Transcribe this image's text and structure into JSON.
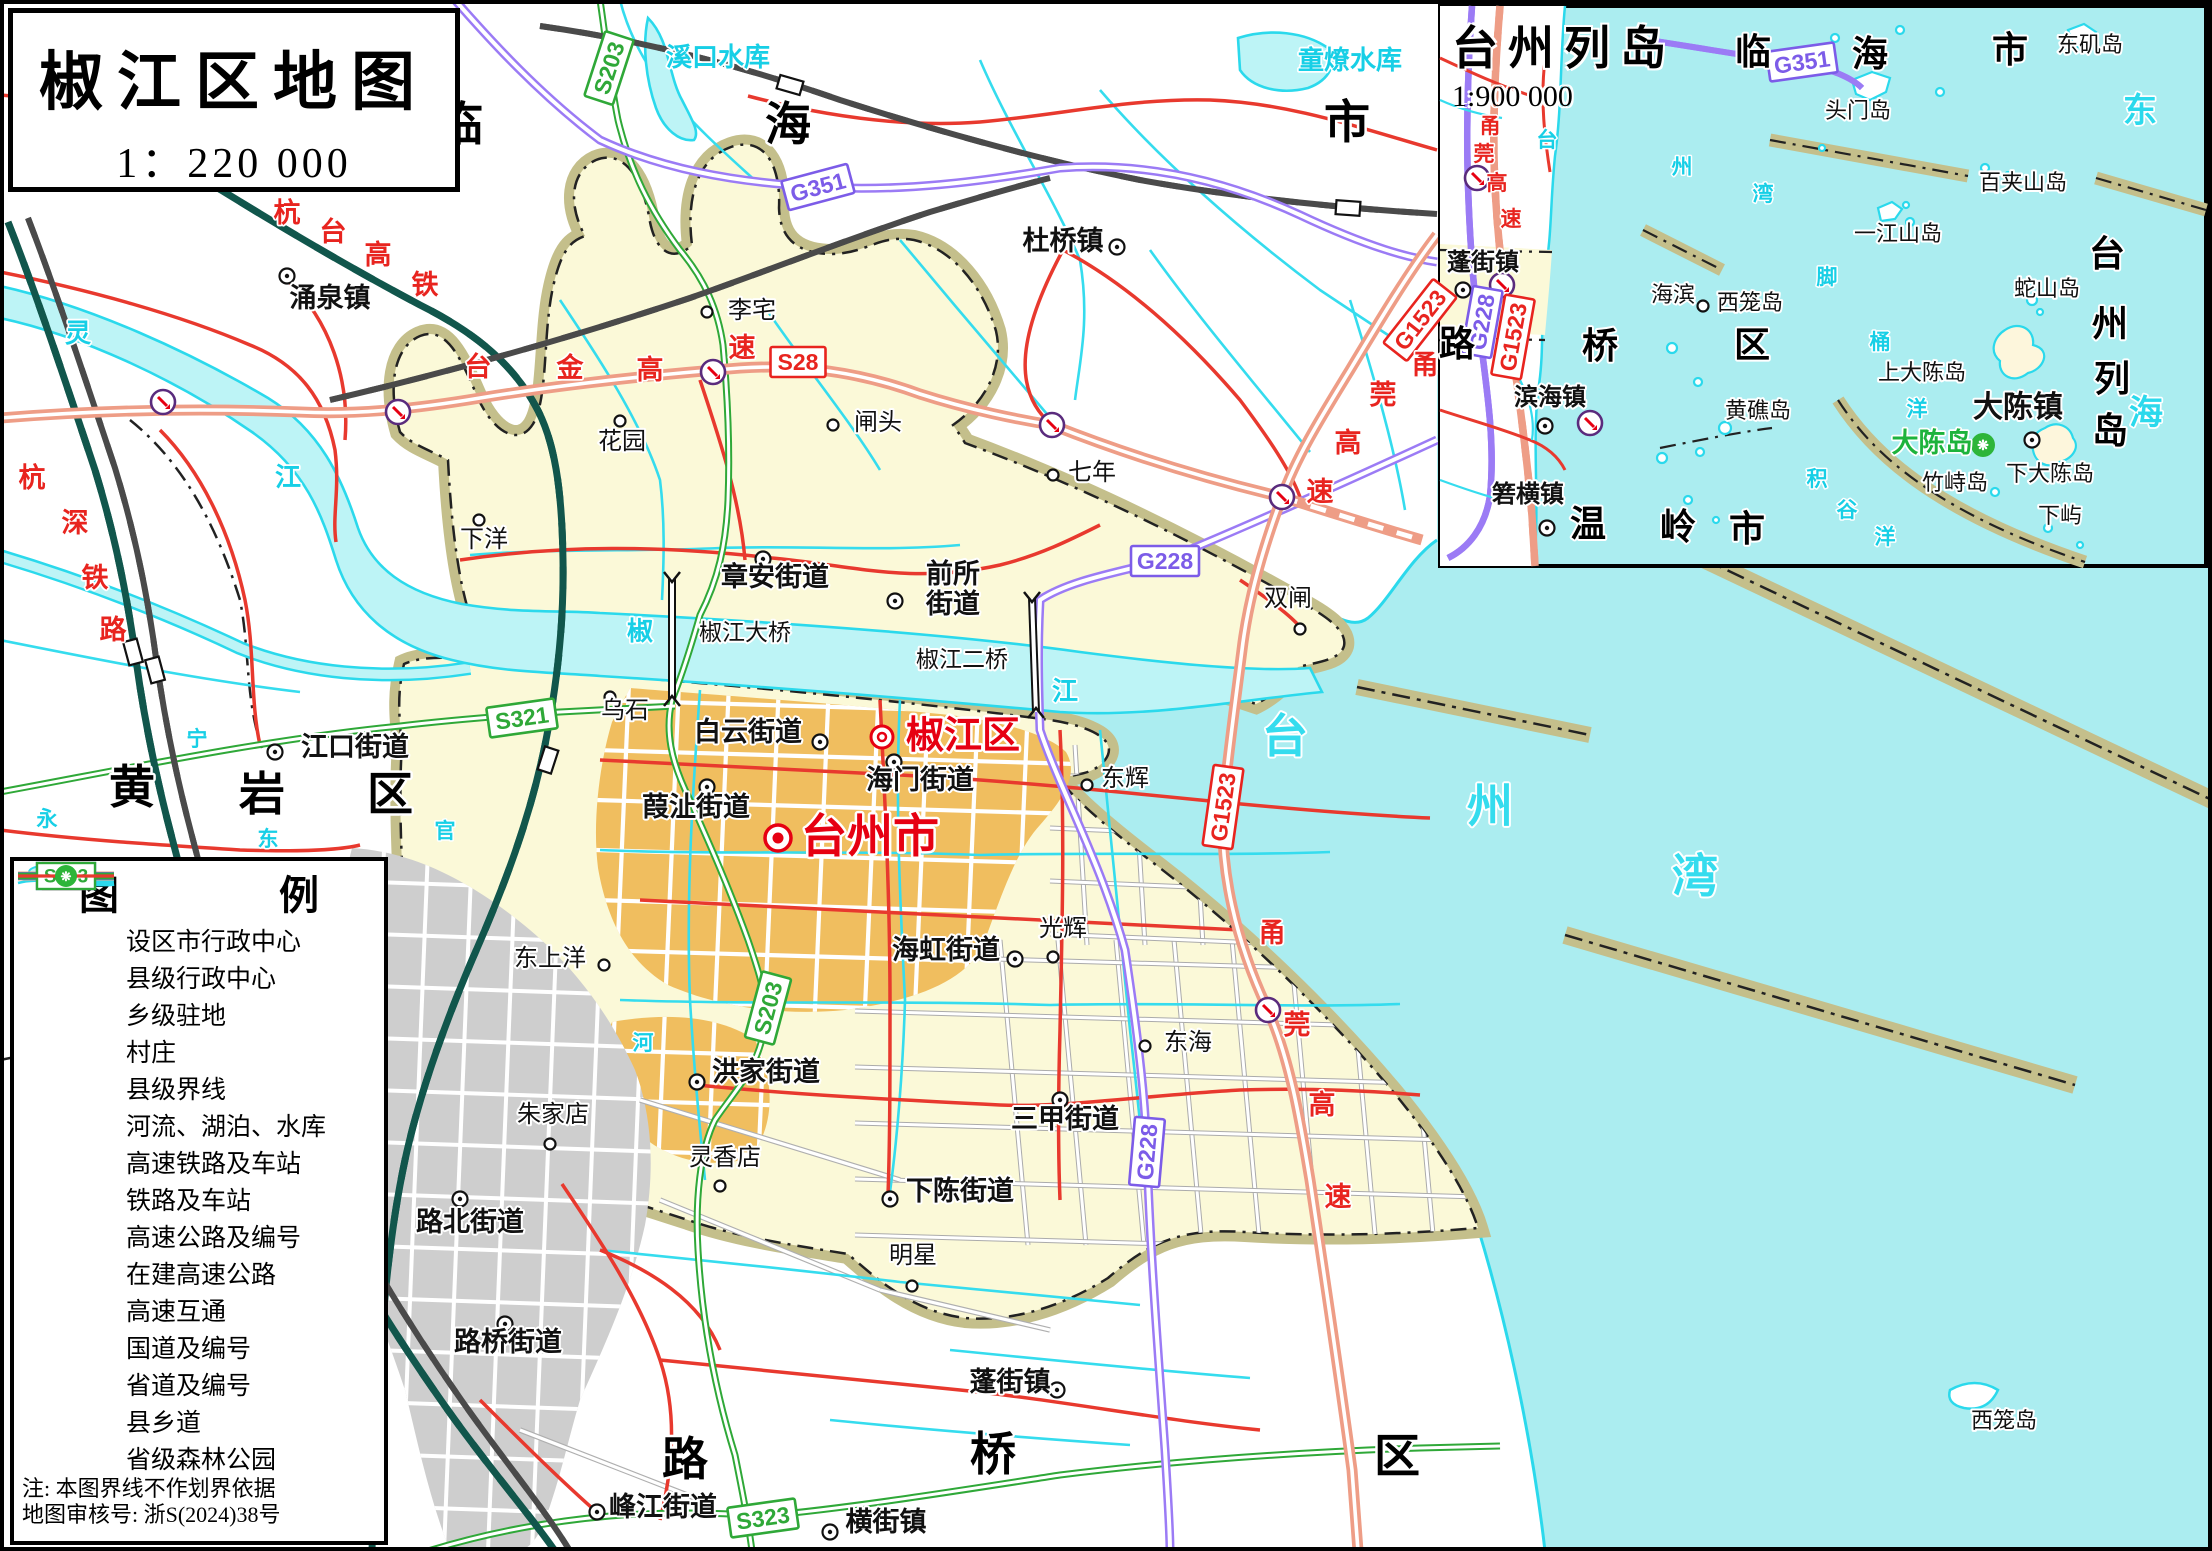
{
  "title_box": {
    "title": "椒江区地图",
    "scale": "1：220 000"
  },
  "inset": {
    "title": "台州列岛",
    "scale": "1:900 000",
    "labels": [
      {
        "t": "临",
        "x": 1753,
        "y": 64,
        "c": "inset-region"
      },
      {
        "t": "海",
        "x": 1870,
        "y": 66,
        "c": "inset-region"
      },
      {
        "t": "市",
        "x": 2010,
        "y": 62,
        "c": "inset-region"
      },
      {
        "t": "路",
        "x": 1457,
        "y": 356,
        "c": "inset-region"
      },
      {
        "t": "桥",
        "x": 1600,
        "y": 358,
        "c": "inset-region"
      },
      {
        "t": "区",
        "x": 1752,
        "y": 357,
        "c": "inset-region"
      },
      {
        "t": "温",
        "x": 1588,
        "y": 536,
        "c": "inset-region"
      },
      {
        "t": "岭",
        "x": 1678,
        "y": 539,
        "c": "inset-region"
      },
      {
        "t": "市",
        "x": 1747,
        "y": 541,
        "c": "inset-region"
      },
      {
        "t": "台",
        "x": 2107,
        "y": 266,
        "c": "inset-region"
      },
      {
        "t": "州",
        "x": 2110,
        "y": 336,
        "c": "inset-region"
      },
      {
        "t": "列",
        "x": 2112,
        "y": 391,
        "c": "inset-region"
      },
      {
        "t": "岛",
        "x": 2110,
        "y": 443,
        "c": "inset-region"
      },
      {
        "t": "东",
        "x": 2140,
        "y": 122,
        "c": "water-md"
      },
      {
        "t": "海",
        "x": 2146,
        "y": 424,
        "c": "water-md"
      },
      {
        "t": "台",
        "x": 1547,
        "y": 147,
        "c": "water-sm"
      },
      {
        "t": "州",
        "x": 1682,
        "y": 174,
        "c": "water-sm"
      },
      {
        "t": "湾",
        "x": 1763,
        "y": 201,
        "c": "water-sm"
      },
      {
        "t": "脚",
        "x": 1827,
        "y": 284,
        "c": "water-sm"
      },
      {
        "t": "桶",
        "x": 1880,
        "y": 349,
        "c": "water-sm"
      },
      {
        "t": "洋",
        "x": 1917,
        "y": 416,
        "c": "water-sm"
      },
      {
        "t": "积",
        "x": 1817,
        "y": 486,
        "c": "water-sm"
      },
      {
        "t": "谷",
        "x": 1847,
        "y": 517,
        "c": "water-sm"
      },
      {
        "t": "洋",
        "x": 1885,
        "y": 544,
        "c": "water-sm"
      },
      {
        "t": "东矶岛",
        "x": 2090,
        "y": 52,
        "c": "island"
      },
      {
        "t": "头门岛",
        "x": 1858,
        "y": 118,
        "c": "island"
      },
      {
        "t": "百夹山岛",
        "x": 2023,
        "y": 190,
        "c": "island"
      },
      {
        "t": "一江山岛",
        "x": 1898,
        "y": 241,
        "c": "island"
      },
      {
        "t": "蛇山岛",
        "x": 2047,
        "y": 296,
        "c": "island"
      },
      {
        "t": "西笼岛",
        "x": 1750,
        "y": 310,
        "c": "island"
      },
      {
        "t": "黄礁岛",
        "x": 1758,
        "y": 418,
        "c": "island"
      },
      {
        "t": "上大陈岛",
        "x": 1922,
        "y": 380,
        "c": "island"
      },
      {
        "t": "下大陈岛",
        "x": 2050,
        "y": 481,
        "c": "island"
      },
      {
        "t": "竹峙岛",
        "x": 1955,
        "y": 490,
        "c": "island"
      },
      {
        "t": "下屿",
        "x": 2060,
        "y": 523,
        "c": "island"
      },
      {
        "t": "海滨",
        "x": 1673,
        "y": 302,
        "c": "island"
      },
      {
        "t": "蓬街镇",
        "x": 1483,
        "y": 270,
        "c": "inset-town"
      },
      {
        "t": "滨海镇",
        "x": 1550,
        "y": 405,
        "c": "inset-town"
      },
      {
        "t": "箬横镇",
        "x": 1528,
        "y": 502,
        "c": "inset-town"
      },
      {
        "t": "大陈镇",
        "x": 2018,
        "y": 417,
        "c": "inset-town-lg"
      },
      {
        "t": "大陈岛",
        "x": 1932,
        "y": 452,
        "c": "green"
      },
      {
        "t": "甬",
        "x": 1490,
        "y": 133,
        "c": "roadname-sm"
      },
      {
        "t": "莞",
        "x": 1484,
        "y": 161,
        "c": "roadname-sm"
      },
      {
        "t": "高",
        "x": 1497,
        "y": 190,
        "c": "roadname-sm"
      },
      {
        "t": "速",
        "x": 1511,
        "y": 226,
        "c": "roadname-sm"
      }
    ],
    "markers": [
      {
        "k": "town",
        "x": 1463,
        "y": 290
      },
      {
        "k": "town",
        "x": 1545,
        "y": 426
      },
      {
        "k": "town",
        "x": 1547,
        "y": 528
      },
      {
        "k": "town",
        "x": 2032,
        "y": 440
      },
      {
        "k": "village",
        "x": 1703,
        "y": 306
      }
    ],
    "badges": [
      {
        "t": "G351",
        "x": 1802,
        "y": 62,
        "r": -8,
        "k": "purple"
      },
      {
        "t": "G228",
        "x": 1482,
        "y": 322,
        "r": -80,
        "k": "purple"
      },
      {
        "t": "G1523",
        "x": 1513,
        "y": 337,
        "r": -80,
        "k": "red"
      }
    ],
    "interchanges": [
      {
        "x": 1477,
        "y": 178
      },
      {
        "x": 1502,
        "y": 285
      },
      {
        "x": 1590,
        "y": 423
      }
    ],
    "forest_icons": [
      {
        "x": 1983,
        "y": 445
      }
    ]
  },
  "legend": {
    "title": "图　例",
    "items": [
      {
        "sym": "city",
        "label": "设区市行政中心"
      },
      {
        "sym": "county",
        "label": "县级行政中心"
      },
      {
        "sym": "town",
        "label": "乡级驻地"
      },
      {
        "sym": "village",
        "label": "村庄"
      },
      {
        "sym": "boundary",
        "label": "县级界线"
      },
      {
        "sym": "water",
        "label": "河流、湖泊、水库"
      },
      {
        "sym": "hsr",
        "label": "高速铁路及车站"
      },
      {
        "sym": "rail",
        "label": "铁路及车站"
      },
      {
        "sym": "expwy",
        "badge": "S28",
        "label": "高速公路及编号"
      },
      {
        "sym": "expwy-uc",
        "label": "在建高速公路"
      },
      {
        "sym": "ic",
        "label": "高速互通"
      },
      {
        "sym": "g-road",
        "badge": "G104",
        "label": "国道及编号"
      },
      {
        "sym": "s-road",
        "badge": "S203",
        "label": "省道及编号"
      },
      {
        "sym": "county-road",
        "label": "县乡道"
      },
      {
        "sym": "forest",
        "label": "省级森林公园"
      }
    ],
    "notes": [
      "注:  本图界线不作划界依据",
      "地图审核号:  浙S(2024)38号"
    ]
  },
  "main_map": {
    "labels": [
      {
        "t": "涌泉镇",
        "x": 330,
        "y": 307,
        "c": "town"
      },
      {
        "t": "杜桥镇",
        "x": 1063,
        "y": 250,
        "c": "town"
      },
      {
        "t": "章安街道",
        "x": 775,
        "y": 586,
        "c": "town"
      },
      {
        "t": "前所",
        "x": 953,
        "y": 583,
        "c": "town"
      },
      {
        "t": "街道",
        "x": 953,
        "y": 613,
        "c": "town"
      },
      {
        "t": "江口街道",
        "x": 355,
        "y": 756,
        "c": "town"
      },
      {
        "t": "白云街道",
        "x": 748,
        "y": 741,
        "c": "town"
      },
      {
        "t": "海门街道",
        "x": 920,
        "y": 789,
        "c": "town"
      },
      {
        "t": "葭沚街道",
        "x": 696,
        "y": 816,
        "c": "town"
      },
      {
        "t": "海虹街道",
        "x": 946,
        "y": 959,
        "c": "town"
      },
      {
        "t": "洪家街道",
        "x": 766,
        "y": 1081,
        "c": "town"
      },
      {
        "t": "三甲街道",
        "x": 1065,
        "y": 1128,
        "c": "town"
      },
      {
        "t": "路北街道",
        "x": 470,
        "y": 1231,
        "c": "town"
      },
      {
        "t": "下陈街道",
        "x": 960,
        "y": 1200,
        "c": "town"
      },
      {
        "t": "路桥街道",
        "x": 508,
        "y": 1351,
        "c": "town"
      },
      {
        "t": "蓬街镇",
        "x": 1010,
        "y": 1391,
        "c": "town"
      },
      {
        "t": "峰江街道",
        "x": 663,
        "y": 1516,
        "c": "town"
      },
      {
        "t": "横街镇",
        "x": 886,
        "y": 1531,
        "c": "town"
      },
      {
        "t": "李宅",
        "x": 752,
        "y": 318,
        "c": "village"
      },
      {
        "t": "花园",
        "x": 622,
        "y": 449,
        "c": "village"
      },
      {
        "t": "闸头",
        "x": 878,
        "y": 430,
        "c": "village"
      },
      {
        "t": "七年",
        "x": 1092,
        "y": 480,
        "c": "village"
      },
      {
        "t": "下洋",
        "x": 484,
        "y": 547,
        "c": "village"
      },
      {
        "t": "双闸",
        "x": 1288,
        "y": 606,
        "c": "village"
      },
      {
        "t": "乌石",
        "x": 625,
        "y": 718,
        "c": "village"
      },
      {
        "t": "东辉",
        "x": 1125,
        "y": 786,
        "c": "village"
      },
      {
        "t": "东上洋",
        "x": 550,
        "y": 966,
        "c": "village"
      },
      {
        "t": "光辉",
        "x": 1063,
        "y": 936,
        "c": "village"
      },
      {
        "t": "东海",
        "x": 1188,
        "y": 1050,
        "c": "village"
      },
      {
        "t": "朱家店",
        "x": 553,
        "y": 1122,
        "c": "village"
      },
      {
        "t": "灵香店",
        "x": 725,
        "y": 1165,
        "c": "village"
      },
      {
        "t": "明星",
        "x": 913,
        "y": 1263,
        "c": "village"
      },
      {
        "t": "西笼岛",
        "x": 2004,
        "y": 1428,
        "c": "island"
      },
      {
        "t": "椒江大桥",
        "x": 745,
        "y": 640,
        "c": "bridge"
      },
      {
        "t": "椒江二桥",
        "x": 962,
        "y": 667,
        "c": "bridge"
      },
      {
        "t": "临",
        "x": 460,
        "y": 140,
        "c": "region"
      },
      {
        "t": "海",
        "x": 788,
        "y": 140,
        "c": "region"
      },
      {
        "t": "市",
        "x": 1347,
        "y": 138,
        "c": "region"
      },
      {
        "t": "黄",
        "x": 132,
        "y": 803,
        "c": "region"
      },
      {
        "t": "岩",
        "x": 262,
        "y": 810,
        "c": "region"
      },
      {
        "t": "区",
        "x": 390,
        "y": 810,
        "c": "region"
      },
      {
        "t": "路",
        "x": 685,
        "y": 1475,
        "c": "region"
      },
      {
        "t": "桥",
        "x": 993,
        "y": 1470,
        "c": "region"
      },
      {
        "t": "区",
        "x": 1397,
        "y": 1472,
        "c": "region"
      },
      {
        "t": "溪口水库",
        "x": 718,
        "y": 66,
        "c": "water"
      },
      {
        "t": "童燎水库",
        "x": 1350,
        "y": 69,
        "c": "water"
      },
      {
        "t": "灵",
        "x": 78,
        "y": 342,
        "c": "water"
      },
      {
        "t": "江",
        "x": 288,
        "y": 486,
        "c": "water"
      },
      {
        "t": "椒",
        "x": 640,
        "y": 640,
        "c": "water"
      },
      {
        "t": "江",
        "x": 1065,
        "y": 700,
        "c": "water"
      },
      {
        "t": "永",
        "x": 47,
        "y": 826,
        "c": "water-sm"
      },
      {
        "t": "宁",
        "x": 197,
        "y": 746,
        "c": "water-sm"
      },
      {
        "t": "东",
        "x": 268,
        "y": 846,
        "c": "water-sm"
      },
      {
        "t": "官",
        "x": 445,
        "y": 838,
        "c": "water-sm"
      },
      {
        "t": "河",
        "x": 643,
        "y": 1050,
        "c": "water-sm"
      },
      {
        "t": "台",
        "x": 1285,
        "y": 752,
        "c": "water-lg"
      },
      {
        "t": "州",
        "x": 1490,
        "y": 822,
        "c": "water-lg"
      },
      {
        "t": "湾",
        "x": 1695,
        "y": 892,
        "c": "water-lg"
      },
      {
        "t": "杭",
        "x": 287,
        "y": 222,
        "c": "roadname"
      },
      {
        "t": "台",
        "x": 333,
        "y": 241,
        "c": "roadname"
      },
      {
        "t": "高",
        "x": 378,
        "y": 264,
        "c": "roadname"
      },
      {
        "t": "铁",
        "x": 425,
        "y": 294,
        "c": "roadname"
      },
      {
        "t": "杭",
        "x": 32,
        "y": 487,
        "c": "roadname"
      },
      {
        "t": "深",
        "x": 75,
        "y": 532,
        "c": "roadname"
      },
      {
        "t": "铁",
        "x": 95,
        "y": 587,
        "c": "roadname"
      },
      {
        "t": "路",
        "x": 113,
        "y": 639,
        "c": "roadname"
      },
      {
        "t": "台",
        "x": 478,
        "y": 376,
        "c": "roadname"
      },
      {
        "t": "金",
        "x": 570,
        "y": 377,
        "c": "roadname"
      },
      {
        "t": "高",
        "x": 650,
        "y": 379,
        "c": "roadname"
      },
      {
        "t": "速",
        "x": 742,
        "y": 357,
        "c": "roadname"
      },
      {
        "t": "甬",
        "x": 1425,
        "y": 374,
        "c": "roadname"
      },
      {
        "t": "莞",
        "x": 1383,
        "y": 404,
        "c": "roadname"
      },
      {
        "t": "高",
        "x": 1348,
        "y": 452,
        "c": "roadname"
      },
      {
        "t": "速",
        "x": 1320,
        "y": 501,
        "c": "roadname"
      },
      {
        "t": "甬",
        "x": 1272,
        "y": 942,
        "c": "roadname"
      },
      {
        "t": "莞",
        "x": 1297,
        "y": 1034,
        "c": "roadname"
      },
      {
        "t": "高",
        "x": 1322,
        "y": 1114,
        "c": "roadname"
      },
      {
        "t": "速",
        "x": 1338,
        "y": 1206,
        "c": "roadname"
      },
      {
        "t": "台州市",
        "x": 870,
        "y": 852,
        "c": "city-red"
      },
      {
        "t": "椒江区",
        "x": 963,
        "y": 748,
        "c": "district-red"
      }
    ],
    "markers": [
      {
        "k": "city",
        "x": 778,
        "y": 838
      },
      {
        "k": "county",
        "x": 882,
        "y": 737
      },
      {
        "k": "town",
        "x": 287,
        "y": 276
      },
      {
        "k": "town",
        "x": 1117,
        "y": 247
      },
      {
        "k": "town",
        "x": 763,
        "y": 559
      },
      {
        "k": "town",
        "x": 895,
        "y": 601
      },
      {
        "k": "town",
        "x": 275,
        "y": 752
      },
      {
        "k": "town",
        "x": 820,
        "y": 742
      },
      {
        "k": "town",
        "x": 894,
        "y": 762
      },
      {
        "k": "town",
        "x": 707,
        "y": 787
      },
      {
        "k": "town",
        "x": 1015,
        "y": 959
      },
      {
        "k": "town",
        "x": 697,
        "y": 1082
      },
      {
        "k": "town",
        "x": 1060,
        "y": 1100
      },
      {
        "k": "town",
        "x": 460,
        "y": 1199
      },
      {
        "k": "town",
        "x": 890,
        "y": 1199
      },
      {
        "k": "town",
        "x": 505,
        "y": 1324
      },
      {
        "k": "town",
        "x": 1057,
        "y": 1390
      },
      {
        "k": "town",
        "x": 597,
        "y": 1512
      },
      {
        "k": "town",
        "x": 830,
        "y": 1532
      },
      {
        "k": "village",
        "x": 707,
        "y": 312
      },
      {
        "k": "village",
        "x": 620,
        "y": 421
      },
      {
        "k": "village",
        "x": 833,
        "y": 425
      },
      {
        "k": "village",
        "x": 1053,
        "y": 475
      },
      {
        "k": "village",
        "x": 479,
        "y": 520
      },
      {
        "k": "village",
        "x": 1300,
        "y": 629
      },
      {
        "k": "village",
        "x": 610,
        "y": 697
      },
      {
        "k": "village",
        "x": 1087,
        "y": 785
      },
      {
        "k": "village",
        "x": 604,
        "y": 965
      },
      {
        "k": "village",
        "x": 1053,
        "y": 957
      },
      {
        "k": "village",
        "x": 1145,
        "y": 1046
      },
      {
        "k": "village",
        "x": 550,
        "y": 1144
      },
      {
        "k": "village",
        "x": 720,
        "y": 1186
      },
      {
        "k": "village",
        "x": 912,
        "y": 1286
      }
    ],
    "badges": [
      {
        "t": "S28",
        "x": 798,
        "y": 362,
        "r": 0,
        "k": "red"
      },
      {
        "t": "S203",
        "x": 609,
        "y": 68,
        "r": -72,
        "k": "green"
      },
      {
        "t": "S203",
        "x": 768,
        "y": 1008,
        "r": -75,
        "k": "green"
      },
      {
        "t": "S321",
        "x": 522,
        "y": 718,
        "r": -8,
        "k": "green"
      },
      {
        "t": "S323",
        "x": 763,
        "y": 1518,
        "r": -8,
        "k": "green"
      },
      {
        "t": "G351",
        "x": 818,
        "y": 187,
        "r": -15,
        "k": "purple"
      },
      {
        "t": "G228",
        "x": 1165,
        "y": 561,
        "r": 0,
        "k": "purple"
      },
      {
        "t": "G228",
        "x": 1147,
        "y": 1152,
        "r": -85,
        "k": "purple"
      },
      {
        "t": "G1523",
        "x": 1420,
        "y": 320,
        "r": -52,
        "k": "red"
      },
      {
        "t": "G1523",
        "x": 1223,
        "y": 807,
        "r": -82,
        "k": "red"
      }
    ],
    "interchanges": [
      {
        "x": 163,
        "y": 402
      },
      {
        "x": 398,
        "y": 412
      },
      {
        "x": 713,
        "y": 372
      },
      {
        "x": 1052,
        "y": 425
      },
      {
        "x": 1282,
        "y": 497
      },
      {
        "x": 1268,
        "y": 1010
      }
    ],
    "stations": [
      {
        "x": 133,
        "y": 652,
        "r": 75
      },
      {
        "x": 155,
        "y": 670,
        "r": 75
      },
      {
        "x": 548,
        "y": 760,
        "r": -72
      },
      {
        "x": 1348,
        "y": 208,
        "r": 4
      },
      {
        "x": 790,
        "y": 85,
        "r": 16
      }
    ]
  },
  "colors": {
    "sea": "#ABEDF0",
    "district": "#FBF9D8",
    "boundary_band": "#C4BF8B",
    "urban": "#F0BE5F",
    "urban_gray": "#CECECE",
    "expressway": "#EE9D86",
    "national_road": "#9B7BF5",
    "provincial_road": "#2FA838",
    "county_road": "#E8392E",
    "hsr": "#11564C",
    "water_line": "#2BD9EC",
    "marker_red": "#E60012",
    "forest_green": "#2DB539"
  }
}
